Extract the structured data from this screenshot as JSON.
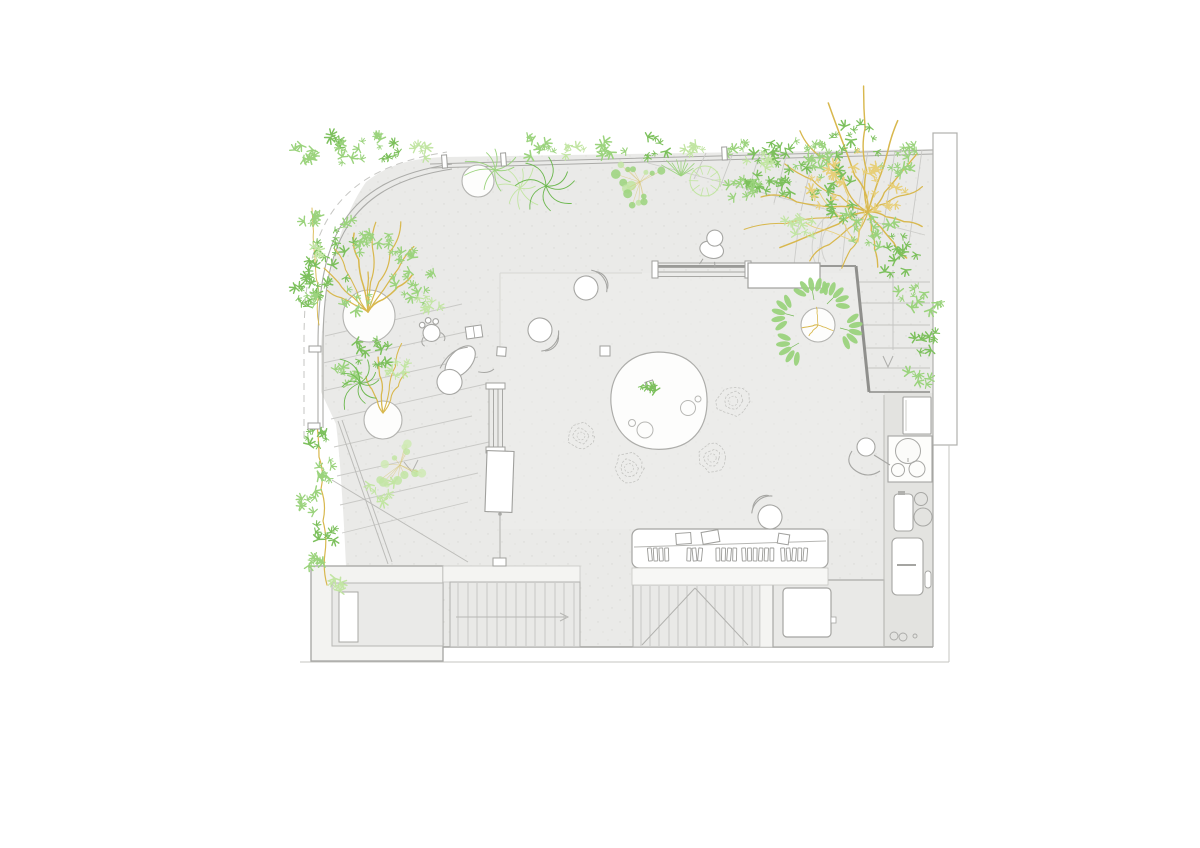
{
  "drawing": {
    "kind": "architectural-roof-garden-plan",
    "background": "#ffffff"
  },
  "palette": {
    "g1": "#7cc05c",
    "g2": "#9bd37d",
    "g3": "#c2e5a3",
    "g4": "#6db84f",
    "pale": "#cfeab4",
    "yellowLight": "#e7cf79",
    "branch": "#d8b84e",
    "line": "#ababa8",
    "lineFaint": "#c9c9c6",
    "wall": "#8f8f8c",
    "floor": "#eaeae8",
    "floorDark": "#e3e3e0",
    "bush": "#c4c4c1",
    "white": "#ffffff",
    "leafStem": "#74b854",
    "dotStem": "#d8c571",
    "figure": "#a6a6a3"
  },
  "planters": [
    {
      "x": 369,
      "y": 316,
      "r": 26
    },
    {
      "x": 383,
      "y": 420,
      "r": 19
    },
    {
      "x": 478,
      "y": 181,
      "r": 16
    },
    {
      "x": 818,
      "y": 325,
      "r": 17
    }
  ],
  "plants": [
    {
      "t": "branches",
      "x": 368,
      "y": 312,
      "c": "branch",
      "w": 1.3,
      "seed": 21,
      "list": [
        [
          -55,
          80
        ],
        [
          -70,
          96
        ],
        [
          -85,
          90
        ],
        [
          -100,
          80
        ],
        [
          -118,
          72
        ],
        [
          -135,
          62
        ],
        [
          -40,
          58
        ],
        [
          -152,
          46
        ],
        [
          -90,
          40
        ]
      ]
    },
    {
      "t": "branches",
      "x": 383,
      "y": 413,
      "c": "branch",
      "w": 1.2,
      "seed": 22,
      "list": [
        [
          -75,
          72
        ],
        [
          -95,
          56
        ],
        [
          -60,
          46
        ],
        [
          -115,
          40
        ]
      ]
    },
    {
      "t": "branches",
      "x": 868,
      "y": 212,
      "c": "branch",
      "w": 1.3,
      "seed": 58,
      "list": [
        [
          172,
          125
        ],
        [
          158,
          95
        ],
        [
          188,
          108
        ],
        [
          210,
          96
        ],
        [
          230,
          106
        ],
        [
          250,
          116
        ],
        [
          268,
          126
        ],
        [
          288,
          96
        ],
        [
          310,
          76
        ],
        [
          335,
          60
        ],
        [
          15,
          56
        ],
        [
          50,
          60
        ],
        [
          80,
          56
        ],
        [
          115,
          62
        ],
        [
          140,
          76
        ]
      ]
    },
    {
      "t": "branches",
      "x": 858,
      "y": 242,
      "c": "yellowLight",
      "w": 1,
      "seed": 59,
      "list": [
        [
          200,
          55
        ],
        [
          232,
          62
        ],
        [
          258,
          70
        ],
        [
          282,
          52
        ]
      ]
    },
    {
      "t": "branches",
      "x": 818,
      "y": 325,
      "c": "branch",
      "w": 0.9,
      "seed": 76,
      "list": [
        [
          -95,
          18
        ],
        [
          170,
          16
        ],
        [
          20,
          16
        ],
        [
          130,
          14
        ]
      ]
    },
    {
      "t": "stem",
      "x1": 312,
      "y1": 208,
      "x2": 319,
      "y2": 325,
      "amp": 3,
      "c": "branch",
      "w": 0.9,
      "seed": 26
    },
    {
      "t": "stem",
      "x1": 317,
      "y1": 425,
      "x2": 327,
      "y2": 585,
      "amp": 5,
      "c": "branch",
      "w": 1.2,
      "seed": 27
    },
    {
      "t": "cluster",
      "x": 337,
      "y": 262,
      "r": 36,
      "n": 24,
      "c": "g1",
      "seed": 11
    },
    {
      "t": "cluster",
      "x": 368,
      "y": 231,
      "r": 26,
      "n": 16,
      "c": "g2",
      "seed": 12
    },
    {
      "t": "cluster",
      "x": 312,
      "y": 293,
      "r": 18,
      "n": 11,
      "c": "g1",
      "seed": 13
    },
    {
      "t": "cluster",
      "x": 356,
      "y": 299,
      "r": 14,
      "n": 8,
      "c": "g2",
      "seed": 14
    },
    {
      "t": "cluster",
      "x": 398,
      "y": 249,
      "r": 17,
      "n": 10,
      "c": "g2",
      "seed": 15
    },
    {
      "t": "cluster",
      "x": 414,
      "y": 283,
      "r": 24,
      "n": 13,
      "c": "g2",
      "seed": 16
    },
    {
      "t": "cluster",
      "x": 429,
      "y": 301,
      "r": 13,
      "n": 7,
      "c": "g3",
      "seed": 17
    },
    {
      "t": "cluster",
      "x": 372,
      "y": 352,
      "r": 20,
      "n": 12,
      "c": "g1",
      "seed": 18
    },
    {
      "t": "cluster",
      "x": 349,
      "y": 372,
      "r": 15,
      "n": 9,
      "c": "g2",
      "seed": 19
    },
    {
      "t": "cluster",
      "x": 397,
      "y": 368,
      "r": 12,
      "n": 7,
      "c": "g3",
      "seed": 20
    },
    {
      "t": "fern",
      "x": 360,
      "y": 383,
      "k": 9,
      "len": 26,
      "c": "g4",
      "seed": 23
    },
    {
      "t": "dots",
      "x": 400,
      "y": 465,
      "r": 27,
      "n": 13,
      "c1": "g3",
      "c2": "pale",
      "seed": 24
    },
    {
      "t": "cluster",
      "x": 382,
      "y": 492,
      "r": 16,
      "n": 8,
      "c": "g3",
      "seed": 25
    },
    {
      "t": "cluster",
      "x": 312,
      "y": 218,
      "r": 10,
      "n": 6,
      "c": "g2",
      "seed": 28
    },
    {
      "t": "cluster",
      "x": 320,
      "y": 252,
      "r": 9,
      "n": 5,
      "c": "g3",
      "seed": 29
    },
    {
      "t": "cluster",
      "x": 311,
      "y": 300,
      "r": 9,
      "n": 5,
      "c": "g2",
      "seed": 30
    },
    {
      "t": "cluster",
      "x": 316,
      "y": 441,
      "r": 13,
      "n": 8,
      "c": "g1",
      "seed": 31
    },
    {
      "t": "cluster",
      "x": 327,
      "y": 470,
      "r": 12,
      "n": 7,
      "c": "g2",
      "seed": 32
    },
    {
      "t": "cluster",
      "x": 312,
      "y": 502,
      "r": 13,
      "n": 8,
      "c": "g2",
      "seed": 33
    },
    {
      "t": "cluster",
      "x": 326,
      "y": 532,
      "r": 13,
      "n": 8,
      "c": "g1",
      "seed": 34
    },
    {
      "t": "cluster",
      "x": 314,
      "y": 562,
      "r": 12,
      "n": 7,
      "c": "g2",
      "seed": 35
    },
    {
      "t": "cluster",
      "x": 331,
      "y": 586,
      "r": 10,
      "n": 6,
      "c": "g3",
      "seed": 36
    },
    {
      "t": "cluster",
      "x": 307,
      "y": 151,
      "r": 12,
      "n": 7,
      "c": "g2",
      "seed": 37
    },
    {
      "t": "cluster",
      "x": 333,
      "y": 143,
      "r": 10,
      "n": 6,
      "c": "g1",
      "seed": 38
    },
    {
      "t": "cluster",
      "x": 371,
      "y": 142,
      "r": 11,
      "n": 6,
      "c": "g2",
      "seed": 39
    },
    {
      "t": "cluster",
      "x": 350,
      "y": 153,
      "r": 14,
      "n": 8,
      "c": "g2",
      "seed": 40
    },
    {
      "t": "cluster",
      "x": 389,
      "y": 149,
      "r": 12,
      "n": 7,
      "c": "g1",
      "seed": 41
    },
    {
      "t": "cluster",
      "x": 421,
      "y": 152,
      "r": 10,
      "n": 6,
      "c": "g3",
      "seed": 42
    },
    {
      "t": "cluster",
      "x": 540,
      "y": 147,
      "r": 16,
      "n": 9,
      "c": "g2",
      "seed": 43
    },
    {
      "t": "cluster",
      "x": 574,
      "y": 151,
      "r": 11,
      "n": 6,
      "c": "g3",
      "seed": 44
    },
    {
      "t": "cluster",
      "x": 613,
      "y": 149,
      "r": 13,
      "n": 7,
      "c": "g2",
      "seed": 45
    },
    {
      "t": "cluster",
      "x": 654,
      "y": 147,
      "r": 13,
      "n": 7,
      "c": "g1",
      "seed": 46
    },
    {
      "t": "cluster",
      "x": 694,
      "y": 149,
      "r": 10,
      "n": 6,
      "c": "g3",
      "seed": 47
    },
    {
      "t": "cluster",
      "x": 739,
      "y": 152,
      "r": 13,
      "n": 7,
      "c": "g2",
      "seed": 48
    },
    {
      "t": "cluster",
      "x": 780,
      "y": 153,
      "r": 15,
      "n": 8,
      "c": "g1",
      "seed": 49
    },
    {
      "t": "cluster",
      "x": 816,
      "y": 159,
      "r": 11,
      "n": 6,
      "c": "g2",
      "seed": 50
    },
    {
      "t": "palm",
      "x": 495,
      "y": 170,
      "k": 9,
      "len": 26,
      "c": "g2",
      "seed": 51
    },
    {
      "t": "palm",
      "x": 520,
      "y": 188,
      "k": 8,
      "len": 22,
      "c": "g3",
      "seed": 52
    },
    {
      "t": "fern",
      "x": 546,
      "y": 186,
      "k": 8,
      "len": 26,
      "c": "g4",
      "seed": 53
    },
    {
      "t": "dots",
      "x": 640,
      "y": 182,
      "r": 30,
      "n": 15,
      "c1": "g2",
      "c2": "g3",
      "seed": 54
    },
    {
      "t": "grass",
      "x": 681,
      "y": 176,
      "k": 9,
      "len": 20,
      "c": "g2",
      "seed": 55
    },
    {
      "t": "bushring",
      "x": 705,
      "y": 181,
      "r": 15,
      "c": "g3",
      "seed": 56
    },
    {
      "t": "cluster",
      "x": 757,
      "y": 181,
      "r": 13,
      "n": 8,
      "c": "g1",
      "seed": 57
    },
    {
      "t": "cluster",
      "x": 775,
      "y": 170,
      "r": 30,
      "n": 17,
      "c": "g1",
      "seed": 60
    },
    {
      "t": "cluster",
      "x": 745,
      "y": 190,
      "r": 19,
      "n": 10,
      "c": "g2",
      "seed": 61
    },
    {
      "t": "cluster",
      "x": 815,
      "y": 155,
      "r": 27,
      "n": 15,
      "c": "g2",
      "seed": 62
    },
    {
      "t": "cluster",
      "x": 855,
      "y": 144,
      "r": 24,
      "n": 13,
      "c": "g1",
      "seed": 63
    },
    {
      "t": "cluster",
      "x": 895,
      "y": 159,
      "r": 24,
      "n": 13,
      "c": "g2",
      "seed": 64
    },
    {
      "t": "cluster",
      "x": 838,
      "y": 194,
      "r": 29,
      "n": 16,
      "c": "g1",
      "seed": 65
    },
    {
      "t": "cluster",
      "x": 872,
      "y": 226,
      "r": 27,
      "n": 15,
      "c": "g2",
      "seed": 66
    },
    {
      "t": "cluster",
      "x": 900,
      "y": 256,
      "r": 24,
      "n": 13,
      "c": "g1",
      "seed": 67
    },
    {
      "t": "cluster",
      "x": 919,
      "y": 300,
      "r": 21,
      "n": 11,
      "c": "g2",
      "seed": 68
    },
    {
      "t": "cluster",
      "x": 927,
      "y": 344,
      "r": 15,
      "n": 8,
      "c": "g1",
      "seed": 69
    },
    {
      "t": "cluster",
      "x": 918,
      "y": 380,
      "r": 12,
      "n": 6,
      "c": "g2",
      "seed": 70
    },
    {
      "t": "cluster",
      "x": 800,
      "y": 224,
      "r": 19,
      "n": 10,
      "c": "g3",
      "seed": 71
    },
    {
      "t": "cluster",
      "x": 760,
      "y": 159,
      "r": 14,
      "n": 7,
      "c": "g3",
      "seed": 72
    },
    {
      "t": "cluster",
      "x": 858,
      "y": 176,
      "r": 28,
      "n": 12,
      "c": "yellowLight",
      "seed": 73
    },
    {
      "t": "cluster",
      "x": 822,
      "y": 186,
      "r": 22,
      "n": 9,
      "c": "yellowLight",
      "seed": 74
    },
    {
      "t": "cluster",
      "x": 888,
      "y": 202,
      "r": 20,
      "n": 9,
      "c": "yellowLight",
      "seed": 75
    },
    {
      "t": "pleaf",
      "x": 814,
      "y": 300,
      "rot": -100,
      "c": "g2"
    },
    {
      "t": "pleaf",
      "x": 794,
      "y": 316,
      "rot": -165,
      "c": "g2"
    },
    {
      "t": "pleaf",
      "x": 799,
      "y": 343,
      "rot": 150,
      "c": "g2"
    },
    {
      "t": "pleaf",
      "x": 840,
      "y": 328,
      "rot": 15,
      "c": "g2"
    },
    {
      "t": "pleaf",
      "x": 827,
      "y": 304,
      "rot": -45,
      "c": "g2"
    },
    {
      "t": "cluster",
      "x": 649,
      "y": 386,
      "r": 9,
      "n": 6,
      "c": "g1",
      "seed": 77
    }
  ],
  "bushes": [
    {
      "x": 733,
      "y": 401,
      "r": 16,
      "seed": 81
    },
    {
      "x": 581,
      "y": 436,
      "r": 13,
      "seed": 82
    },
    {
      "x": 629,
      "y": 468,
      "r": 15,
      "seed": 83
    },
    {
      "x": 712,
      "y": 458,
      "r": 14,
      "seed": 84
    }
  ],
  "people": [
    {
      "pose": "pouf",
      "x": 586,
      "y": 288,
      "rot": -20
    },
    {
      "pose": "pouf",
      "x": 540,
      "y": 330,
      "rot": 55
    },
    {
      "pose": "lying",
      "x": 449,
      "y": 379,
      "rot": -10
    },
    {
      "pose": "child",
      "x": 431,
      "y": 331,
      "rot": -15
    },
    {
      "pose": "sit",
      "x": 714,
      "y": 241,
      "rot": 15
    },
    {
      "pose": "pouf",
      "x": 770,
      "y": 517,
      "rot": -115
    },
    {
      "pose": "lean",
      "x": 864,
      "y": 453,
      "rot": 0
    }
  ],
  "posts": [
    {
      "x": 442,
      "y": 155,
      "w": 5,
      "h": 13,
      "r": -4
    },
    {
      "x": 501,
      "y": 153,
      "w": 5,
      "h": 13,
      "r": -4
    },
    {
      "x": 722,
      "y": 147,
      "w": 5,
      "h": 13,
      "r": -3
    },
    {
      "x": 309,
      "y": 346,
      "w": 12,
      "h": 6,
      "r": 0
    },
    {
      "x": 308,
      "y": 423,
      "w": 12,
      "h": 6,
      "r": 0
    }
  ],
  "shelf": {
    "trays": [
      {
        "x": 676,
        "y": 533,
        "w": 15,
        "h": 11,
        "r": -4
      },
      {
        "x": 702,
        "y": 531,
        "w": 17,
        "h": 12,
        "r": -10
      },
      {
        "x": 778,
        "y": 534,
        "w": 11,
        "h": 10,
        "r": 9
      }
    ],
    "book_groups": [
      {
        "x": 648,
        "n": 4
      },
      {
        "x": 687,
        "n": 3
      },
      {
        "x": 716,
        "n": 4
      },
      {
        "x": 742,
        "n": 6
      },
      {
        "x": 781,
        "n": 5
      }
    ]
  }
}
